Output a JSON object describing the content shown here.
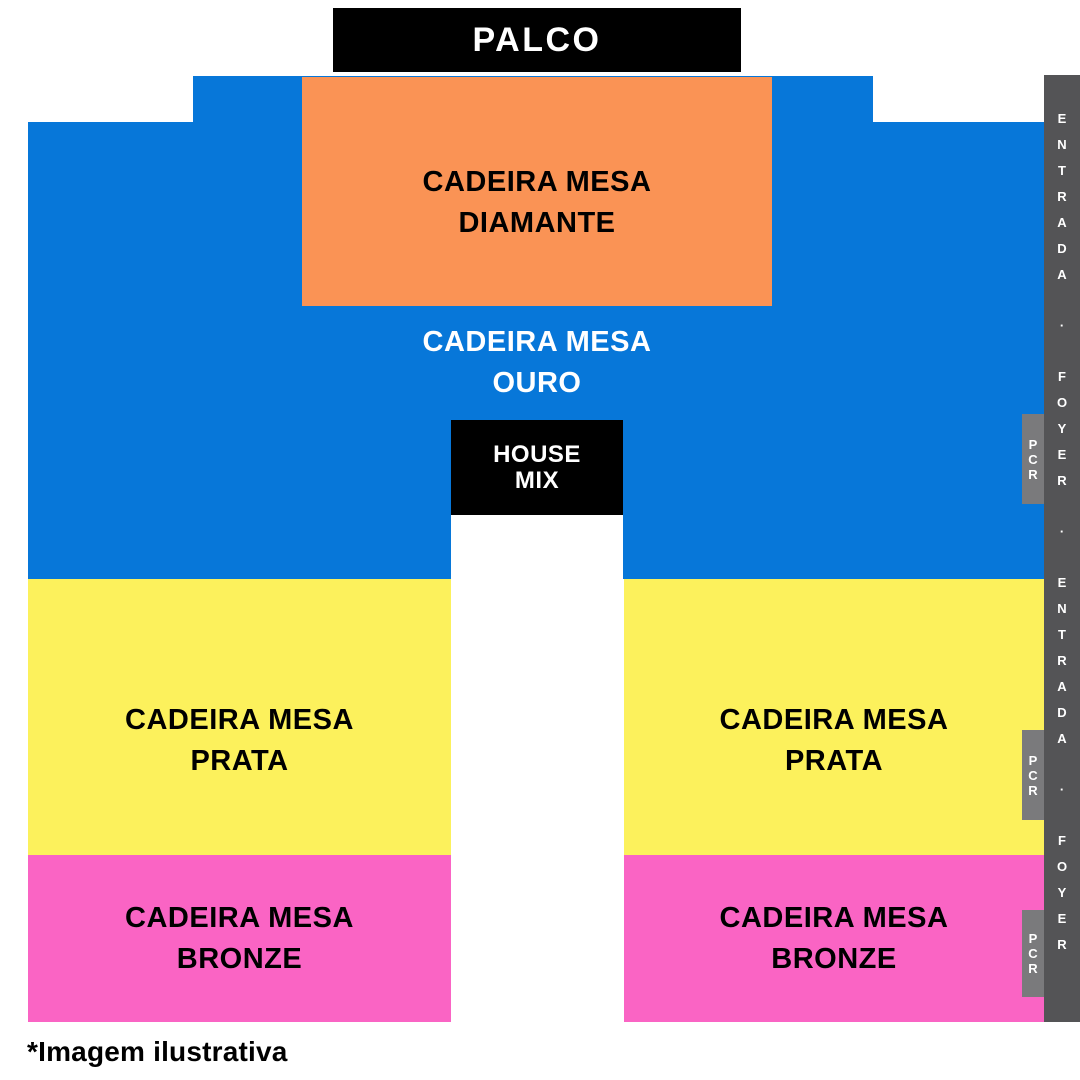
{
  "stage": {
    "label": "PALCO"
  },
  "sections": {
    "diamante": {
      "line1": "CADEIRA MESA",
      "line2": "DIAMANTE"
    },
    "ouro": {
      "line1": "CADEIRA MESA",
      "line2": "OURO"
    },
    "prata_left": {
      "line1": "CADEIRA MESA",
      "line2": "PRATA"
    },
    "prata_right": {
      "line1": "CADEIRA MESA",
      "line2": "PRATA"
    },
    "bronze_left": {
      "line1": "CADEIRA MESA",
      "line2": "BRONZE"
    },
    "bronze_right": {
      "line1": "CADEIRA MESA",
      "line2": "BRONZE"
    }
  },
  "house_mix": {
    "line1": "HOUSE",
    "line2": "MIX"
  },
  "entrance_strip": {
    "text": "ENTRADA · FOYER · ENTRADA · FOYER"
  },
  "pcr_boxes": [
    "PCR",
    "PCR",
    "PCR"
  ],
  "footnote": {
    "text": "*Imagem ilustrativa"
  },
  "colors": {
    "stage_bg": "#000000",
    "ouro_floor": "#0777d9",
    "diamante": "#fa9355",
    "prata": "#fcf15c",
    "bronze": "#fa64c4",
    "entrance_strip": "#545456",
    "pcr_box": "#7a7a7c",
    "house_mix_bg": "#000000",
    "light_text": "#ffffff",
    "dark_text": "#000000"
  }
}
